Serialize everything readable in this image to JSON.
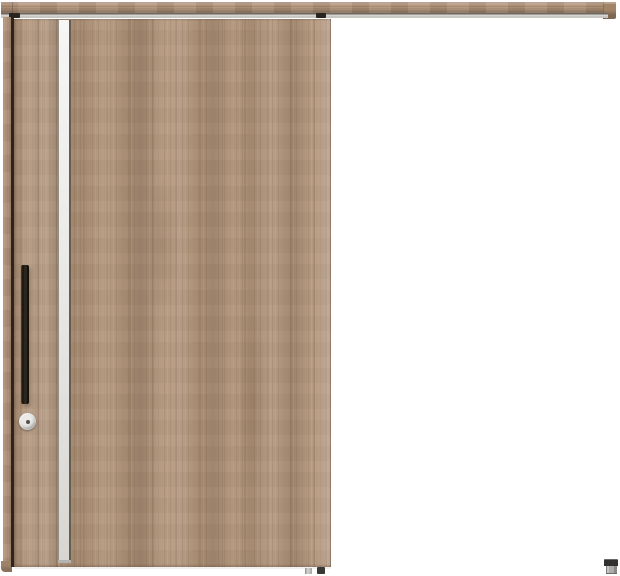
{
  "scene": {
    "type": "product-image",
    "subject": "wood-outset-sliding-door-closed",
    "canvas": {
      "width": 620,
      "height": 576
    },
    "visible_text": []
  },
  "palette": {
    "background": "#ffffff",
    "wood_base": "#b19379",
    "wood_light": "#c7ae92",
    "wood_dark": "#95785f",
    "rail_bottom_edge": "#6e5a45",
    "track_dark": "#6d6862",
    "track_silver": "#c9c7c4",
    "frame_gap_dark": "#30241a",
    "accent_strip_top": "#f7f6f4",
    "accent_strip_bottom": "#d9d6d2",
    "accent_strip_edge_dark": "#665d52",
    "handle_dark": "#262019",
    "lock_ring": "#929090",
    "lock_face": "#ebeae8",
    "lock_center": "#54504b",
    "hardware_dark": "#31302e",
    "hardware_silver": "#aeacaa"
  },
  "parts": {
    "hanger_rail": "wood-hanger-rail",
    "rail_track": "metal-track",
    "rail_end_cap": "rail-end-cap",
    "hanger_bracket_left": "door-hanger-left",
    "hanger_bracket_right": "door-hanger-right",
    "frame_post": "left-frame-post",
    "door_panel": "sliding-door-panel",
    "accent_strip": "vertical-accent-strip",
    "bar_handle": "vertical-bar-handle",
    "thumb_turn_lock": "round-thumb-turn-lock",
    "floor_guide_silver": "floor-guide-silver",
    "floor_guide_dark": "floor-guide-dark",
    "floor_door_stop": "floor-door-stop"
  }
}
